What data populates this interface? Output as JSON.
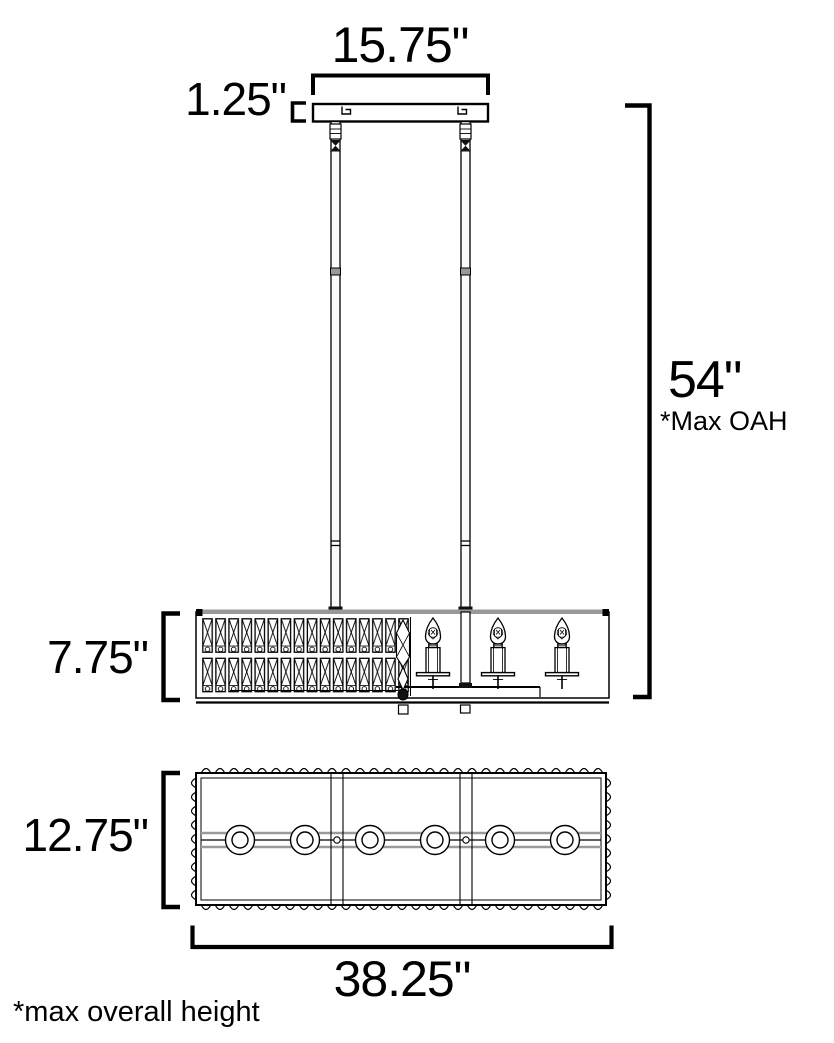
{
  "page": {
    "type": "product-dimension-diagram",
    "subject": "linear chandelier line drawing, side elevation and bottom plan view",
    "background": "#ffffff"
  },
  "dimensions": {
    "canopy_width": {
      "value": "15.75\""
    },
    "canopy_height": {
      "value": "1.25\""
    },
    "max_overall_height": {
      "value": "54\"",
      "note": "*Max OAH"
    },
    "fixture_height": {
      "value": "7.75\""
    },
    "fixture_depth": {
      "value": "12.75\""
    },
    "fixture_width": {
      "value": "38.25\""
    }
  },
  "footnote": "*max overall height",
  "colors": {
    "line": "#000000",
    "accent_gray": "#999999",
    "background": "#ffffff"
  }
}
